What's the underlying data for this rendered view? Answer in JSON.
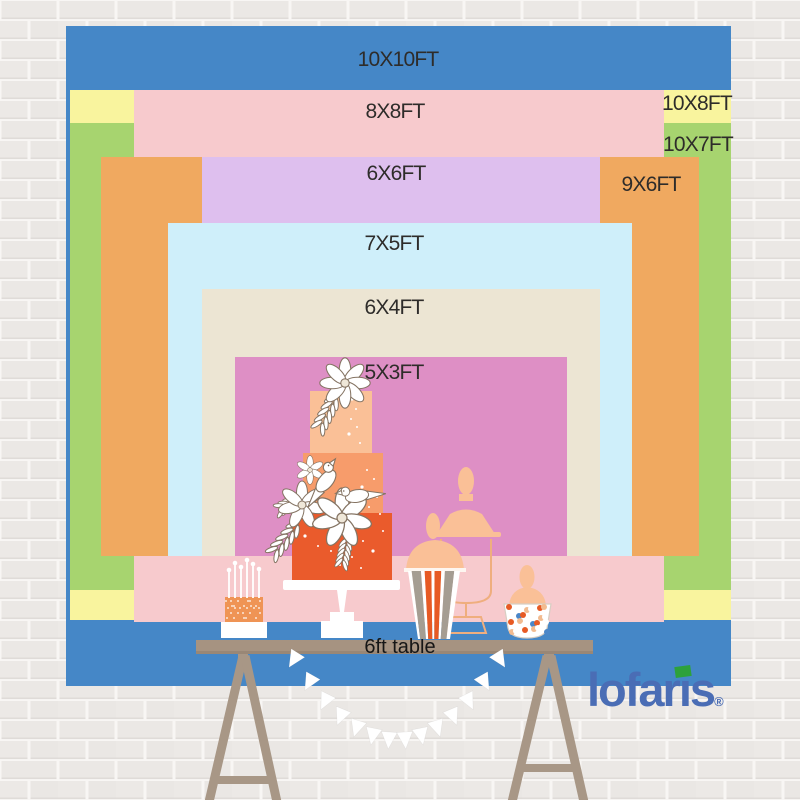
{
  "page": {
    "width": 800,
    "height": 800,
    "description": "Backdrop size comparison chart hung over a dessert table against a white brick wall"
  },
  "palette": {
    "blue": "#4587c7",
    "yellow": "#f9f49e",
    "green": "#a7d46f",
    "pink": "#f7cacd",
    "orange": "#f0a960",
    "purple": "#debfee",
    "light_blue": "#cfeffa",
    "cream": "#ece5d3",
    "magenta": "#de8fc5",
    "table": "#a69381",
    "leg": "#a89786",
    "cake_top": "#fac097",
    "cake_mid": "#f79c6b",
    "cake_bottom": "#ea5b2c",
    "candy_orange": "#e75a24",
    "candy_peach": "#f2bb90",
    "stripe_taupe": "#a59d92",
    "label_text": "#2e2c2a",
    "logo_blue": "#4a6db5",
    "logo_green": "#2da13c"
  },
  "backdrop_chart": {
    "type": "size-comparison",
    "unit": "FT",
    "layers": [
      {
        "id": "10x10ft",
        "label": "10X10FT",
        "width_ft": 10,
        "height_ft": 10,
        "color": "#4587c7",
        "rect": [
          66,
          26,
          665,
          660
        ],
        "label_pos": [
          398,
          60
        ]
      },
      {
        "id": "10x8ft",
        "label": "10X8FT",
        "width_ft": 10,
        "height_ft": 8,
        "color": "#f9f49e",
        "rect": [
          70,
          90,
          661,
          530
        ],
        "label_pos": [
          697,
          104
        ]
      },
      {
        "id": "10x7ft",
        "label": "10X7FT",
        "width_ft": 10,
        "height_ft": 7,
        "color": "#a7d46f",
        "rect": [
          70,
          123,
          661,
          467
        ],
        "label_pos": [
          698,
          145
        ]
      },
      {
        "id": "8x8ft",
        "label": "8X8FT",
        "width_ft": 8,
        "height_ft": 8,
        "color": "#f7cacd",
        "rect": [
          134,
          90,
          530,
          532
        ],
        "label_pos": [
          395,
          112
        ]
      },
      {
        "id": "9x6ft",
        "label": "9X6FT",
        "width_ft": 9,
        "height_ft": 6,
        "color": "#f0a960",
        "rect": [
          101,
          157,
          598,
          399
        ],
        "label_pos": [
          651,
          185
        ]
      },
      {
        "id": "6x6ft",
        "label": "6X6FT",
        "width_ft": 6,
        "height_ft": 6,
        "color": "#debfee",
        "rect": [
          202,
          157,
          398,
          399
        ],
        "label_pos": [
          396,
          174
        ]
      },
      {
        "id": "7x5ft",
        "label": "7X5FT",
        "width_ft": 7,
        "height_ft": 5,
        "color": "#cfeffa",
        "rect": [
          168,
          223,
          464,
          333
        ],
        "label_pos": [
          394,
          244
        ]
      },
      {
        "id": "6x4ft",
        "label": "6X4FT",
        "width_ft": 6,
        "height_ft": 4,
        "color": "#ece5d3",
        "rect": [
          202,
          289,
          398,
          267
        ],
        "label_pos": [
          394,
          308
        ]
      },
      {
        "id": "5x3ft",
        "label": "5X3FT",
        "width_ft": 5,
        "height_ft": 3,
        "color": "#de8fc5",
        "rect": [
          235,
          357,
          332,
          199
        ],
        "label_pos": [
          394,
          373
        ]
      }
    ]
  },
  "table": {
    "label": "6ft table"
  },
  "brand": {
    "name": "lofaris",
    "display": {
      "pre": "lofar",
      "i": "ı",
      "post": "s"
    },
    "registered_mark": "®"
  },
  "scene_items": [
    "candle-cake",
    "tiered-cake",
    "popcorn-box",
    "apothecary-jar",
    "candy-jar",
    "pennant-banner",
    "trestle-table"
  ]
}
